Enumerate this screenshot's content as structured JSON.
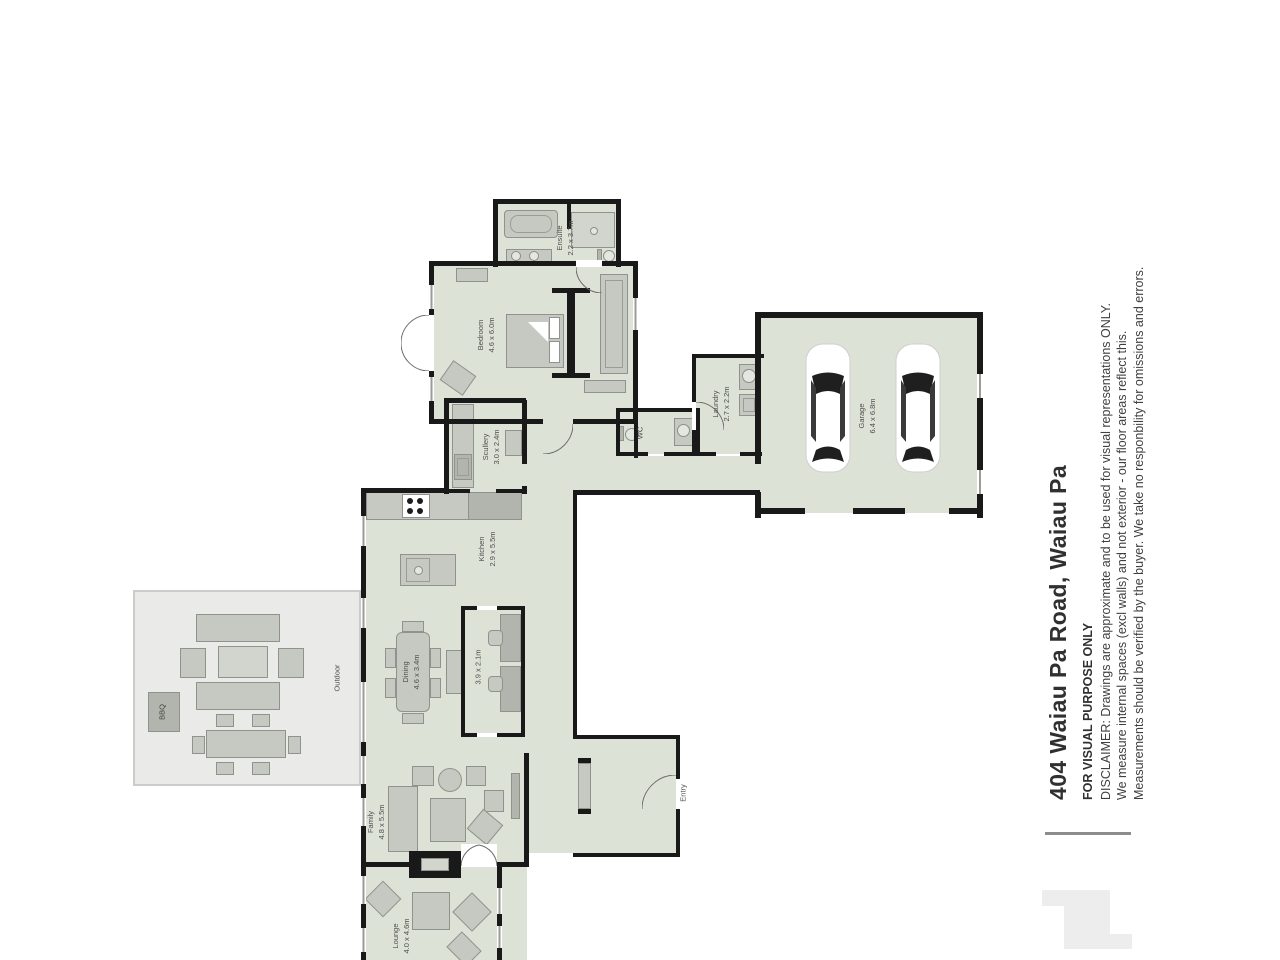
{
  "palette": {
    "room_fill": "#dde2d7",
    "deck_fill": "#eaeae8",
    "wall": "#191919",
    "furniture": "#c6c9c2",
    "label_text": "#4e4e4e",
    "title_text": "#303030",
    "logo": "#ededed"
  },
  "title_block": {
    "address": "404 Waiau Pa Road, Waiau Pa",
    "purpose": "FOR VISUAL PURPOSE ONLY",
    "disclaimer_lines": [
      "DISCLAIMER: Drawings are approximate and to be used for visual representations ONLY.",
      "We measure internal spaces (excl walls) and not exterior - our floor areas reflect this.",
      "Measurements should be verified by the buyer. We take no responbility for omissions and errors."
    ]
  },
  "rooms": {
    "ensuite": {
      "name": "Ensuite",
      "dims": "2.2 x 3.7m"
    },
    "bedroom": {
      "name": "Bedroom",
      "dims": "4.6 x 6.0m"
    },
    "wc": {
      "name": "WC"
    },
    "laundry": {
      "name": "Laundry",
      "dims": "2.7 x 2.2m"
    },
    "garage": {
      "name": "Garage",
      "dims": "6.4 x 6.8m"
    },
    "scullery": {
      "name": "Scullery",
      "dims": "3.0 x 2.4m"
    },
    "kitchen": {
      "name": "Kitchen",
      "dims": "2.9 x 5.5m"
    },
    "dining": {
      "name": "Dining",
      "dims": "4.6 x 3.4m"
    },
    "study": {
      "dims": "3.9 x 2.1m"
    },
    "family": {
      "name": "Family",
      "dims": "4.8 x 5.5m"
    },
    "lounge": {
      "name": "Lounge",
      "dims": "4.0 x 4.6m"
    },
    "entry": {
      "name": "Entry"
    },
    "outdoor": {
      "name": "Outdoor"
    },
    "bbq": {
      "name": "BBQ"
    }
  }
}
